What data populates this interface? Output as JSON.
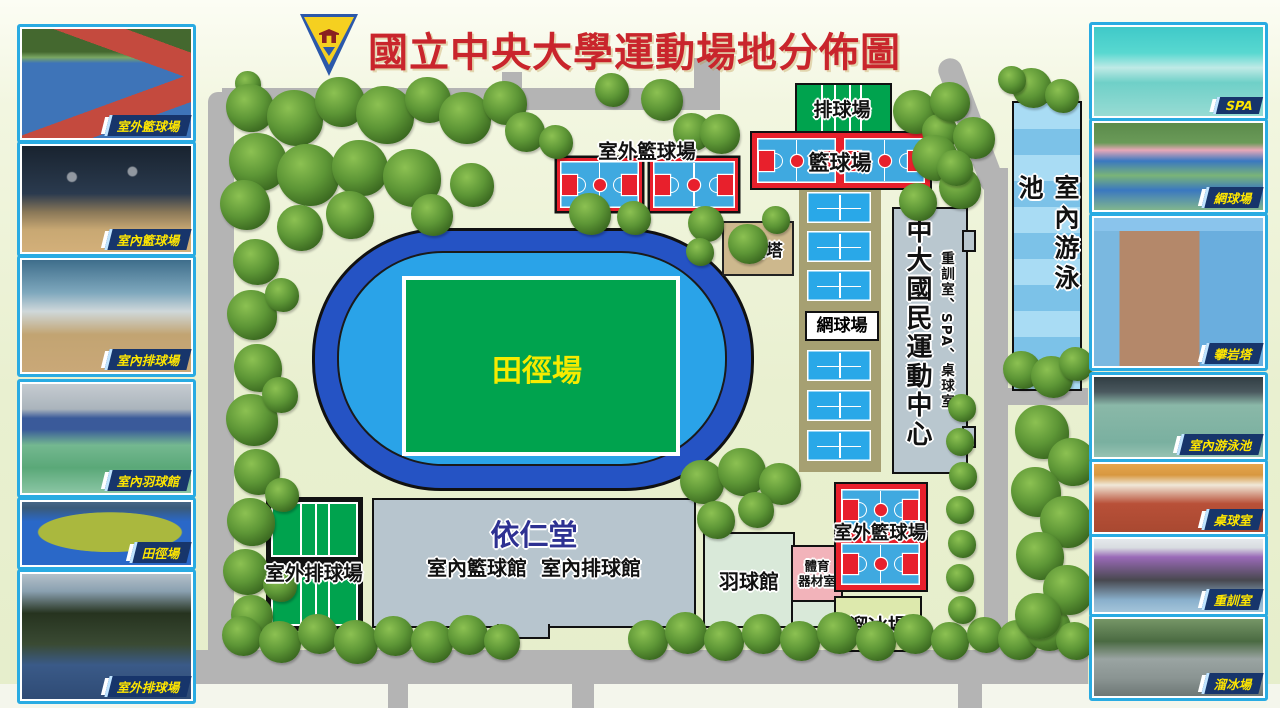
{
  "title": "國立中央大學運動場地分佈圖",
  "colors": {
    "title_red": "#c9252c",
    "road_gray": "#b4b4b4",
    "track_ring_blue": "#2553c4",
    "track_lane_blue": "#2aa3e8",
    "field_green": "#00a34e",
    "court_blue": "#3fa9e0",
    "court_red": "#e8202c",
    "ribbon_bg": "#17356b",
    "ribbon_text": "#ffe600",
    "photo_border": "#29abe2"
  },
  "left_photos": [
    {
      "label": "室外籃球場"
    },
    {
      "label": "室內籃球場"
    },
    {
      "label": "室內排球場"
    },
    {
      "label": "室內羽球館"
    },
    {
      "label": "田徑場"
    },
    {
      "label": "室外排球場"
    }
  ],
  "right_photos": [
    {
      "label": "SPA"
    },
    {
      "label": "網球場"
    },
    {
      "label": "攀岩塔"
    },
    {
      "label": "室內游泳池"
    },
    {
      "label": "桌球室"
    },
    {
      "label": "重訓室"
    },
    {
      "label": "溜冰場"
    }
  ],
  "map": {
    "volleyball_court": "排球場",
    "outdoor_basketball_north": "室外籃球場",
    "basketball_court": "籃球場",
    "climbing_tower": "攀岩塔",
    "tennis_court": "網球場",
    "sports_center": "中大國民運動中心",
    "sports_center_rooms": "重訓室、SPA、桌球室",
    "indoor_pool": "室內游泳池",
    "track_field": "田徑場",
    "outdoor_volleyball": "室外排球場",
    "yi_ren_hall": "依仁堂",
    "yi_ren_hall_sub": "室內籃球館  室內排球館",
    "badminton_hall": "羽球館",
    "equipment_room_line1": "體育",
    "equipment_room_line2": "器材室",
    "outdoor_basketball_south": "室外籃球場",
    "skating_rink": "溜冰場"
  }
}
